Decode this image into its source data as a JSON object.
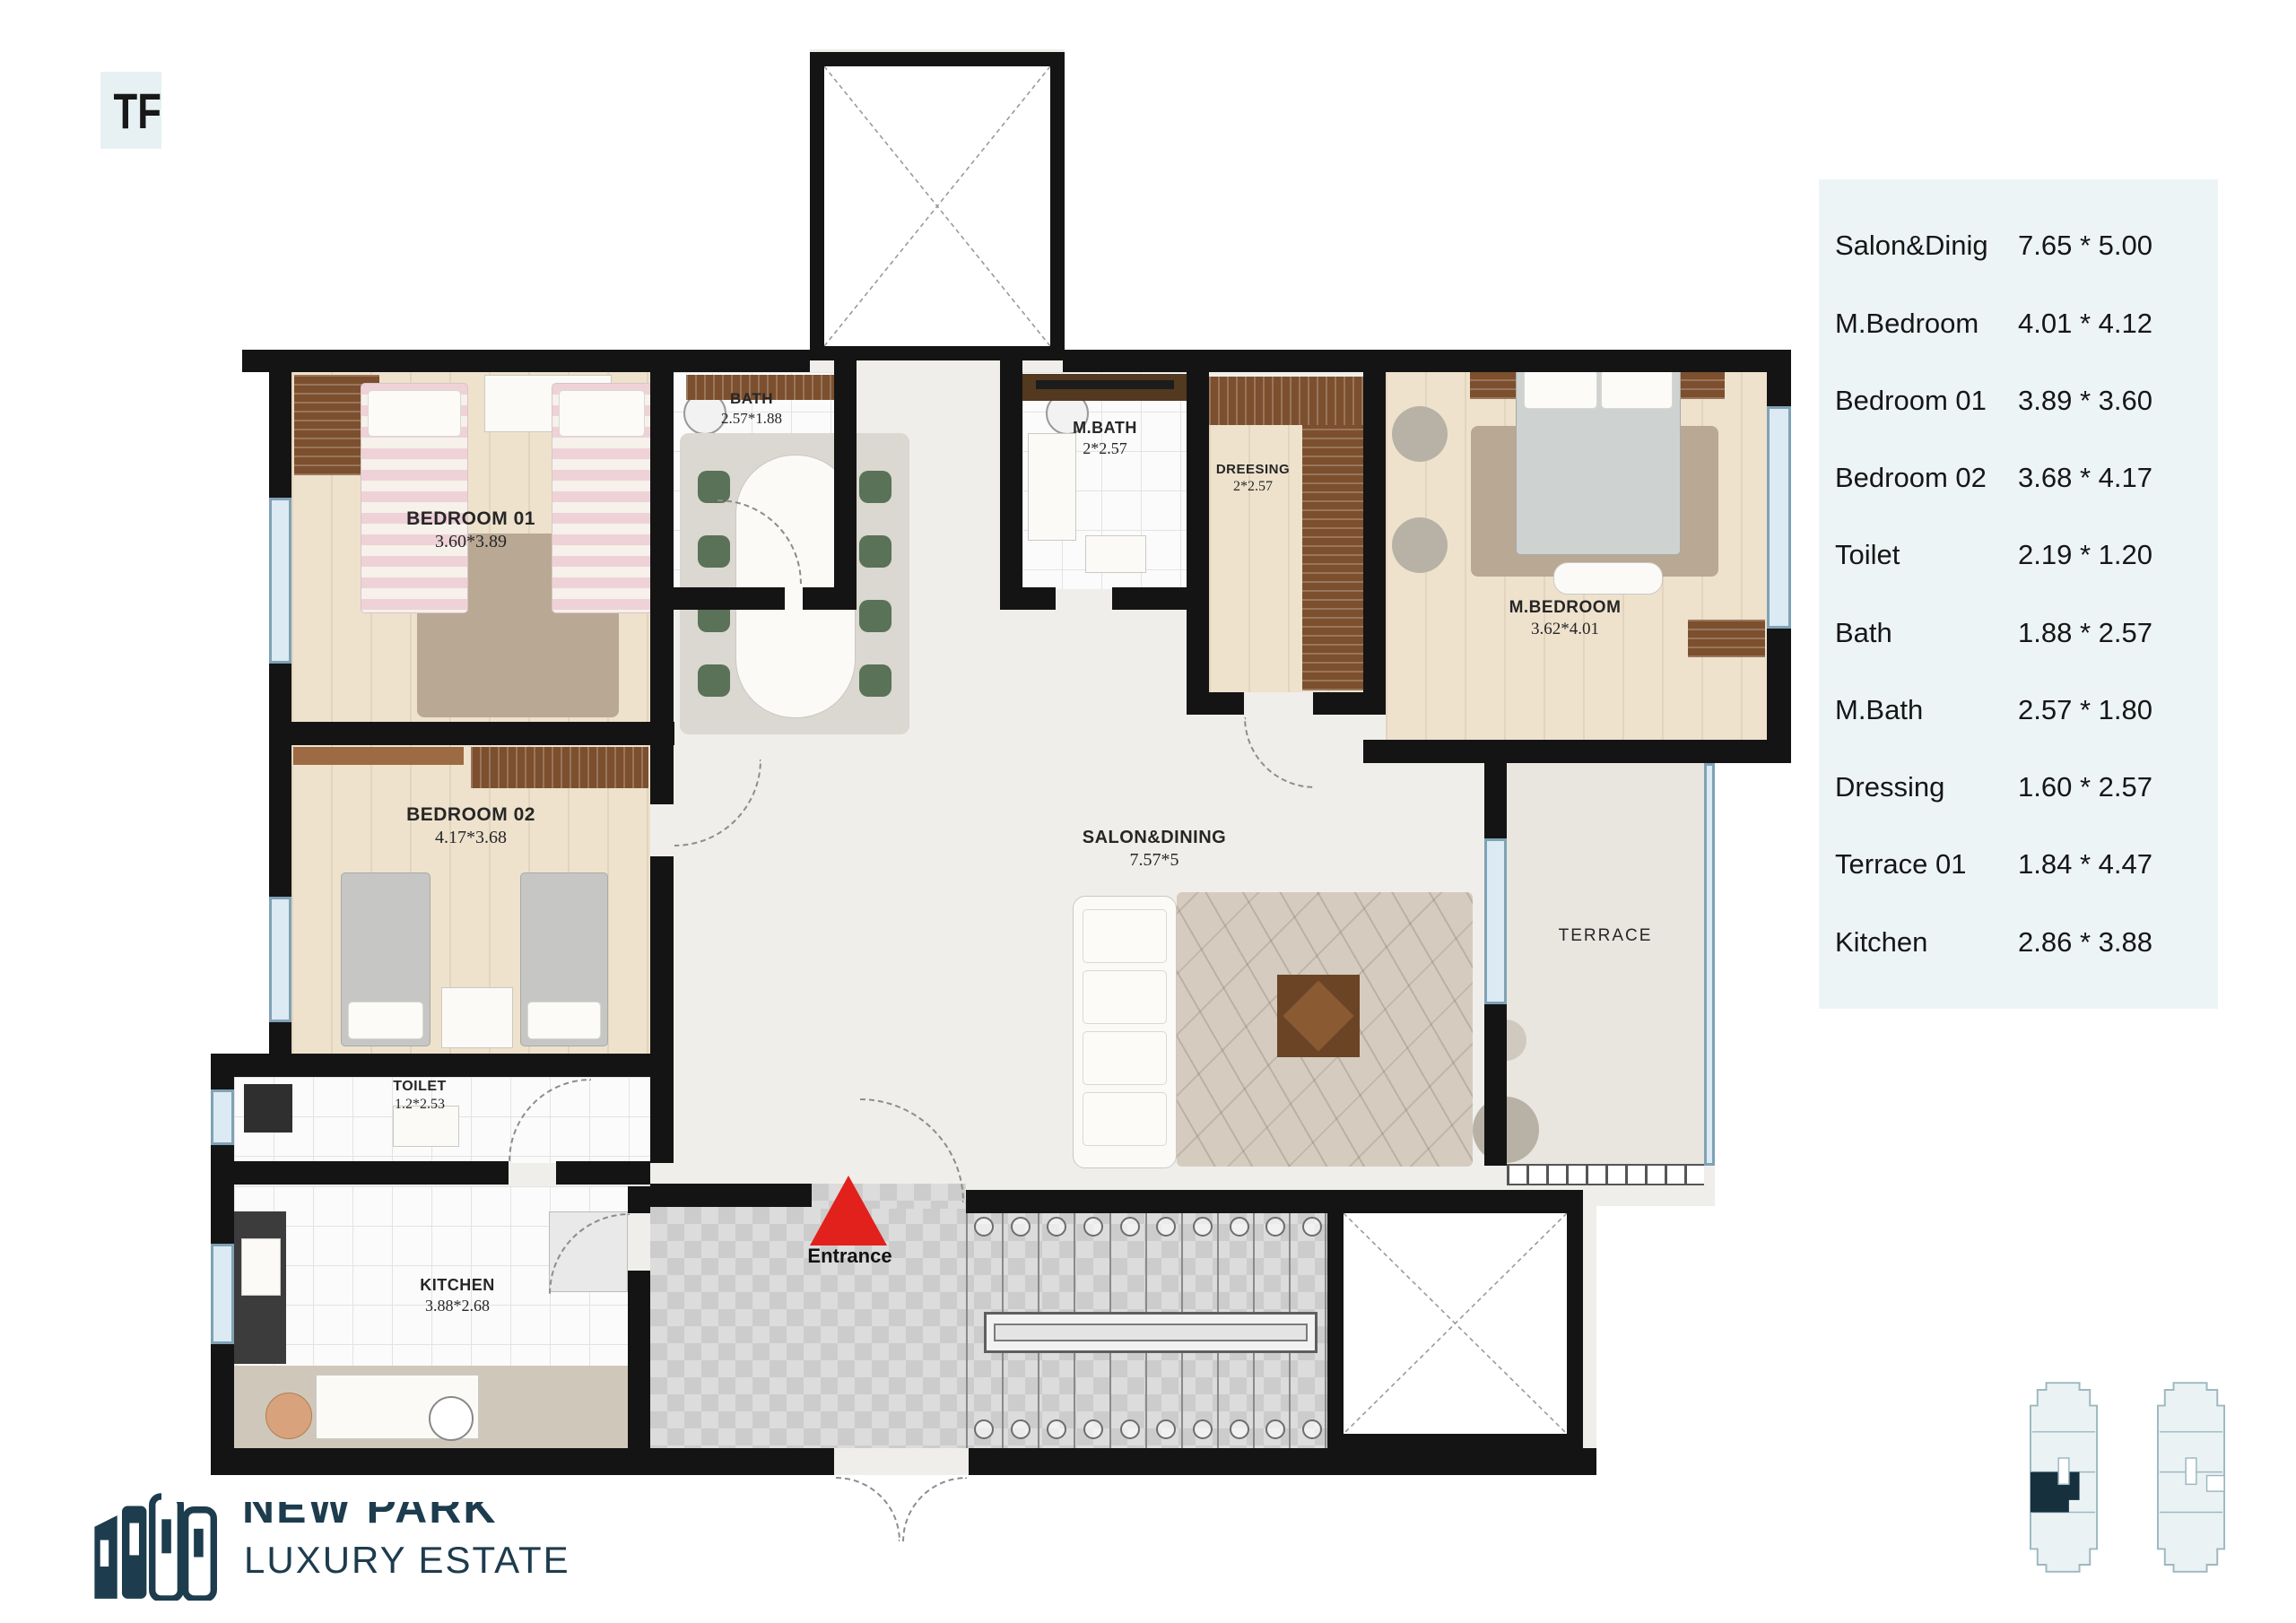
{
  "header": {
    "unit_badge": "TF 02 - 1,2,3,4,5",
    "area_badge": "186 M"
  },
  "dimensions_table": {
    "rows": [
      {
        "label": "Salon&Dinig",
        "value": "7.65 * 5.00"
      },
      {
        "label": "M.Bedroom",
        "value": "4.01 * 4.12"
      },
      {
        "label": "Bedroom 01",
        "value": "3.89 * 3.60"
      },
      {
        "label": "Bedroom 02",
        "value": "3.68 * 4.17"
      },
      {
        "label": "Toilet",
        "value": "2.19 * 1.20"
      },
      {
        "label": "Bath",
        "value": "1.88 * 2.57"
      },
      {
        "label": "M.Bath",
        "value": "2.57 * 1.80"
      },
      {
        "label": "Dressing",
        "value": "1.60 * 2.57"
      },
      {
        "label": "Terrace 01",
        "value": "1.84 * 4.47"
      },
      {
        "label": "Kitchen",
        "value": "2.86 * 3.88"
      }
    ]
  },
  "floor_plan": {
    "rooms": {
      "bedroom01": {
        "name": "BEDROOM 01",
        "size": "3.60*3.89"
      },
      "bath": {
        "name": "BATH",
        "size": "2.57*1.88"
      },
      "mbath": {
        "name": "M.BATH",
        "size": "2*2.57"
      },
      "dressing": {
        "name": "DREESING",
        "size": "2*2.57"
      },
      "mbedroom": {
        "name": "M.BEDROOM",
        "size": "3.62*4.01"
      },
      "bedroom02": {
        "name": "BEDROOM 02",
        "size": "4.17*3.68"
      },
      "salon": {
        "name": "SALON&DINING",
        "size": "7.57*5"
      },
      "terrace": {
        "name": "TERRACE"
      },
      "toilet": {
        "name": "TOILET",
        "size": "1.2*2.53"
      },
      "kitchen": {
        "name": "KITCHEN",
        "size": "3.88*2.68"
      }
    },
    "entrance_label": "Entrance"
  },
  "branding": {
    "name": "NEW PARK",
    "tagline": "LUXURY ESTATE"
  },
  "colors": {
    "entrance_arrow_red": "#e2211c",
    "brand_navy": "#1d3c4e",
    "badge_bg": "#e7f0f3",
    "panel_bg": "#edf4f6",
    "wall_black": "#141414",
    "window_blue": "#bcd9ea"
  }
}
